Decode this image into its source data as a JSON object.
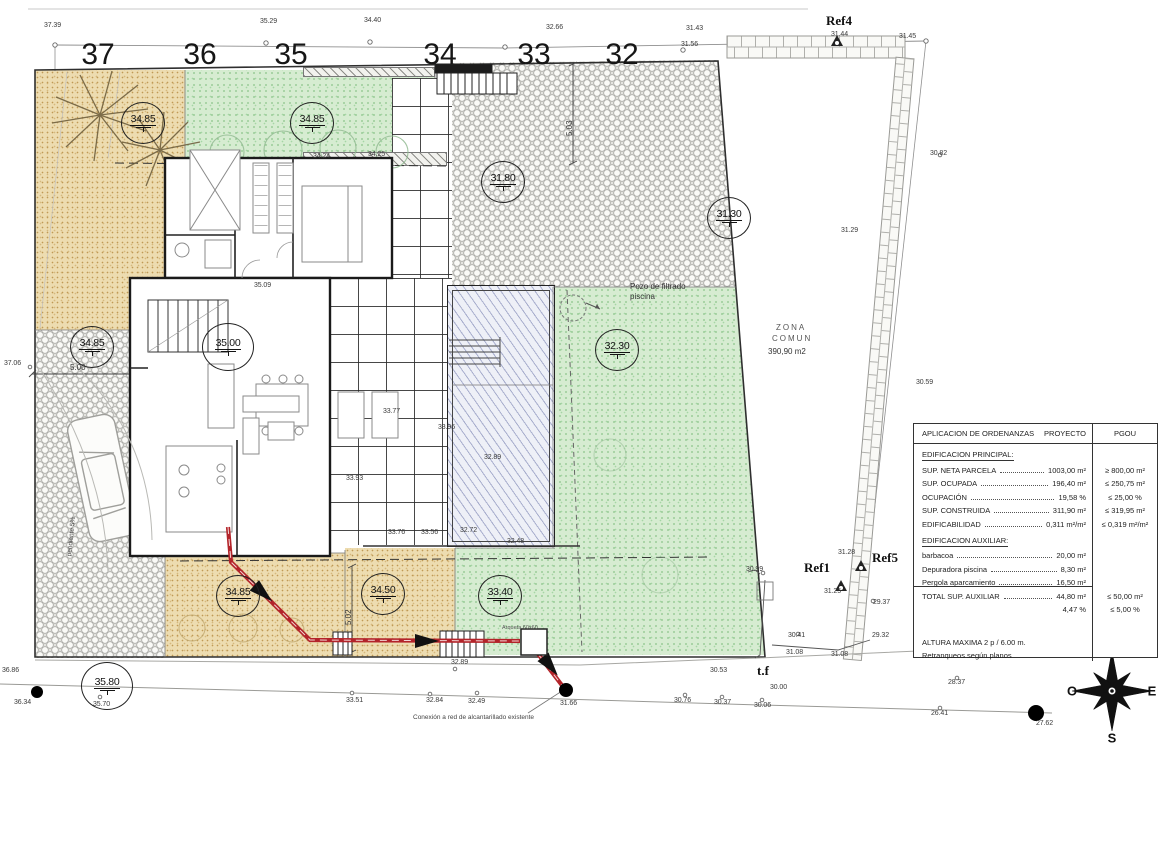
{
  "plot_numbers": [
    {
      "text": "37",
      "x": 98,
      "y": 38
    },
    {
      "text": "36",
      "x": 200,
      "y": 38
    },
    {
      "text": "35",
      "x": 291,
      "y": 38
    },
    {
      "text": "34",
      "x": 440,
      "y": 38
    },
    {
      "text": "33",
      "x": 534,
      "y": 38
    },
    {
      "text": "32",
      "x": 622,
      "y": 38
    }
  ],
  "level_markers": [
    {
      "value": "34.85",
      "x": 143,
      "y": 123
    },
    {
      "value": "34.85",
      "x": 312,
      "y": 123
    },
    {
      "value": "31.80",
      "x": 503,
      "y": 182
    },
    {
      "value": "31.30",
      "x": 729,
      "y": 218
    },
    {
      "value": "34.85",
      "x": 92,
      "y": 347
    },
    {
      "value": "35.00",
      "x": 228,
      "y": 347,
      "cls": "big"
    },
    {
      "value": "32.30",
      "x": 617,
      "y": 350
    },
    {
      "value": "34.85",
      "x": 238,
      "y": 596
    },
    {
      "value": "34.50",
      "x": 383,
      "y": 594
    },
    {
      "value": "33.40",
      "x": 500,
      "y": 596
    },
    {
      "value": "35.80",
      "x": 107,
      "y": 686,
      "cls": "big"
    }
  ],
  "spot_elevations": [
    {
      "text": "37.39",
      "x": 44,
      "y": 22
    },
    {
      "text": "35.29",
      "x": 260,
      "y": 18
    },
    {
      "text": "34.40",
      "x": 364,
      "y": 17
    },
    {
      "text": "32.66",
      "x": 546,
      "y": 24
    },
    {
      "text": "31.43",
      "x": 686,
      "y": 25
    },
    {
      "text": "31.56",
      "x": 681,
      "y": 41
    },
    {
      "text": "31.44",
      "x": 831,
      "y": 31
    },
    {
      "text": "31.45",
      "x": 899,
      "y": 33
    },
    {
      "text": "30.82",
      "x": 930,
      "y": 150
    },
    {
      "text": "31.29",
      "x": 841,
      "y": 227
    },
    {
      "text": "30.59",
      "x": 916,
      "y": 379
    },
    {
      "text": "31.28",
      "x": 838,
      "y": 549
    },
    {
      "text": "30.99",
      "x": 746,
      "y": 566
    },
    {
      "text": "31.25",
      "x": 824,
      "y": 588
    },
    {
      "text": "29.37",
      "x": 873,
      "y": 599
    },
    {
      "text": "29.32",
      "x": 872,
      "y": 632
    },
    {
      "text": "30.41",
      "x": 788,
      "y": 632
    },
    {
      "text": "31.08",
      "x": 786,
      "y": 649
    },
    {
      "text": "31.08",
      "x": 831,
      "y": 651
    },
    {
      "text": "30.53",
      "x": 710,
      "y": 667
    },
    {
      "text": "30.00",
      "x": 770,
      "y": 684
    },
    {
      "text": "30.76",
      "x": 674,
      "y": 697
    },
    {
      "text": "30.37",
      "x": 714,
      "y": 699
    },
    {
      "text": "30.06",
      "x": 754,
      "y": 702
    },
    {
      "text": "28.37",
      "x": 948,
      "y": 679
    },
    {
      "text": "26.41",
      "x": 931,
      "y": 710
    },
    {
      "text": "27.62",
      "x": 1036,
      "y": 720
    },
    {
      "text": "31.66",
      "x": 560,
      "y": 700
    },
    {
      "text": "32.49",
      "x": 468,
      "y": 698
    },
    {
      "text": "32.84",
      "x": 426,
      "y": 697
    },
    {
      "text": "33.51",
      "x": 346,
      "y": 697
    },
    {
      "text": "32.89",
      "x": 451,
      "y": 659
    },
    {
      "text": "35.70",
      "x": 93,
      "y": 701
    },
    {
      "text": "36.34",
      "x": 14,
      "y": 699
    },
    {
      "text": "36.86",
      "x": 2,
      "y": 667
    },
    {
      "text": "37.06",
      "x": 4,
      "y": 360
    },
    {
      "text": "34.24",
      "x": 313,
      "y": 153
    },
    {
      "text": "34.25",
      "x": 368,
      "y": 151
    },
    {
      "text": "35.09",
      "x": 254,
      "y": 282
    },
    {
      "text": "33.77",
      "x": 383,
      "y": 408
    },
    {
      "text": "33.96",
      "x": 438,
      "y": 424
    },
    {
      "text": "33.93",
      "x": 346,
      "y": 475
    },
    {
      "text": "32.89",
      "x": 484,
      "y": 454
    },
    {
      "text": "33.76",
      "x": 388,
      "y": 529
    },
    {
      "text": "33.56",
      "x": 421,
      "y": 529
    },
    {
      "text": "32.72",
      "x": 460,
      "y": 527
    },
    {
      "text": "32.48",
      "x": 507,
      "y": 538
    }
  ],
  "refs": [
    {
      "text": "Ref4",
      "x": 826,
      "y": 13
    },
    {
      "text": "Ref1",
      "x": 804,
      "y": 560
    },
    {
      "text": "Ref5",
      "x": 872,
      "y": 550
    }
  ],
  "annotations": [
    {
      "text": "Pozo de filtrado",
      "x": 630,
      "y": 282,
      "cls": "a8"
    },
    {
      "text": "piscina",
      "x": 630,
      "y": 292,
      "cls": "a8"
    },
    {
      "text": "ZONA",
      "x": 776,
      "y": 323,
      "cls": "a8 sp"
    },
    {
      "text": "COMUN",
      "x": 772,
      "y": 334,
      "cls": "a8 sp"
    },
    {
      "text": "390,90 m2",
      "x": 768,
      "y": 347,
      "cls": "a8"
    },
    {
      "text": "Arqueta 60x60",
      "x": 502,
      "y": 625,
      "cls": "a6"
    },
    {
      "text": "Conexión a red de alcantarillado existente",
      "x": 413,
      "y": 714,
      "cls": "a7"
    },
    {
      "text": "t.f",
      "x": 757,
      "y": 663,
      "cls": "tf"
    },
    {
      "text": "pendiente 5%",
      "x": 66,
      "y": 556,
      "rot": -84,
      "cls": "a7"
    }
  ],
  "dimensions": [
    {
      "text": "5.00",
      "x": 70,
      "y": 363
    },
    {
      "text": "5.03",
      "x": 565,
      "y": 136,
      "rot": -90
    },
    {
      "text": "5.02",
      "x": 344,
      "y": 625,
      "rot": -90
    }
  ],
  "compass": {
    "north": "N",
    "south": "S",
    "east": "E",
    "west": "O"
  },
  "table": {
    "header": {
      "col1": "APLICACION DE ORDENANZAS",
      "col2": "PROYECTO",
      "col3": "PGOU"
    },
    "rows": [
      {
        "type": "section",
        "label": "EDIFICACION PRINCIPAL:"
      },
      {
        "type": "data",
        "leader": true,
        "label": "SUP. NETA PARCELA",
        "proyecto": "1003,00 m²",
        "pgou": "≥ 800,00 m²"
      },
      {
        "type": "data",
        "leader": true,
        "label": "SUP. OCUPADA",
        "proyecto": "196,40 m²",
        "pgou": "≤ 250,75 m²"
      },
      {
        "type": "data",
        "leader": true,
        "label": "OCUPACIÓN",
        "proyecto": "19,58 %",
        "pgou": "≤ 25,00 %"
      },
      {
        "type": "data",
        "leader": true,
        "label": "SUP. CONSTRUIDA",
        "proyecto": "311,90 m²",
        "pgou": "≤ 319,95 m²"
      },
      {
        "type": "data",
        "leader": true,
        "label": "EDIFICABILIDAD",
        "proyecto": "0,311 m²/m²",
        "pgou": "≤ 0,319 m²/m²"
      },
      {
        "type": "section",
        "label": "EDIFICACION AUXILIAR:"
      },
      {
        "type": "data",
        "leader": true,
        "label": "barbacoa",
        "proyecto": "20,00 m²",
        "pgou": ""
      },
      {
        "type": "data",
        "leader": true,
        "label": "Depuradora piscina",
        "proyecto": "8,30 m²",
        "pgou": ""
      },
      {
        "type": "data",
        "leader": true,
        "label": "Pergola aparcamiento",
        "proyecto": "16,50 m²",
        "pgou": ""
      },
      {
        "type": "data",
        "leader": true,
        "cls": "topline",
        "label": "TOTAL SUP. AUXILIAR",
        "proyecto": "44,80 m²",
        "pgou": "≤ 50,00 m²"
      },
      {
        "type": "data",
        "label": "",
        "proyecto": "4,47 %",
        "pgou": "≤ 5,00 %"
      },
      {
        "type": "spacer",
        "label": ""
      },
      {
        "type": "plain",
        "label": "ALTURA MAXIMA      2 p  / 6.00 m."
      },
      {
        "type": "plain",
        "label": "Retranqueos según planos"
      }
    ]
  }
}
